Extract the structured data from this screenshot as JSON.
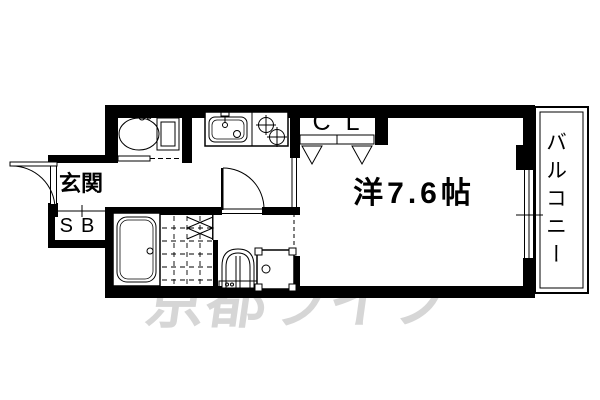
{
  "floorplan": {
    "labels": {
      "entrance": "玄関",
      "shoe_box": "SB",
      "closet": "CL",
      "main_room": "洋7.6帖",
      "balcony": "バルコニー"
    },
    "watermark": {
      "text": "京都ライフ",
      "color": "#d6d6d6"
    },
    "colors": {
      "line": "#000000",
      "background": "#ffffff"
    },
    "fixtures": [
      "toilet-icon",
      "kitchen-sink-icon",
      "stove-icon",
      "bathtub-icon",
      "shower-floor",
      "folding-door-icon",
      "washbasin-icon",
      "washing-machine-pan-icon"
    ]
  }
}
